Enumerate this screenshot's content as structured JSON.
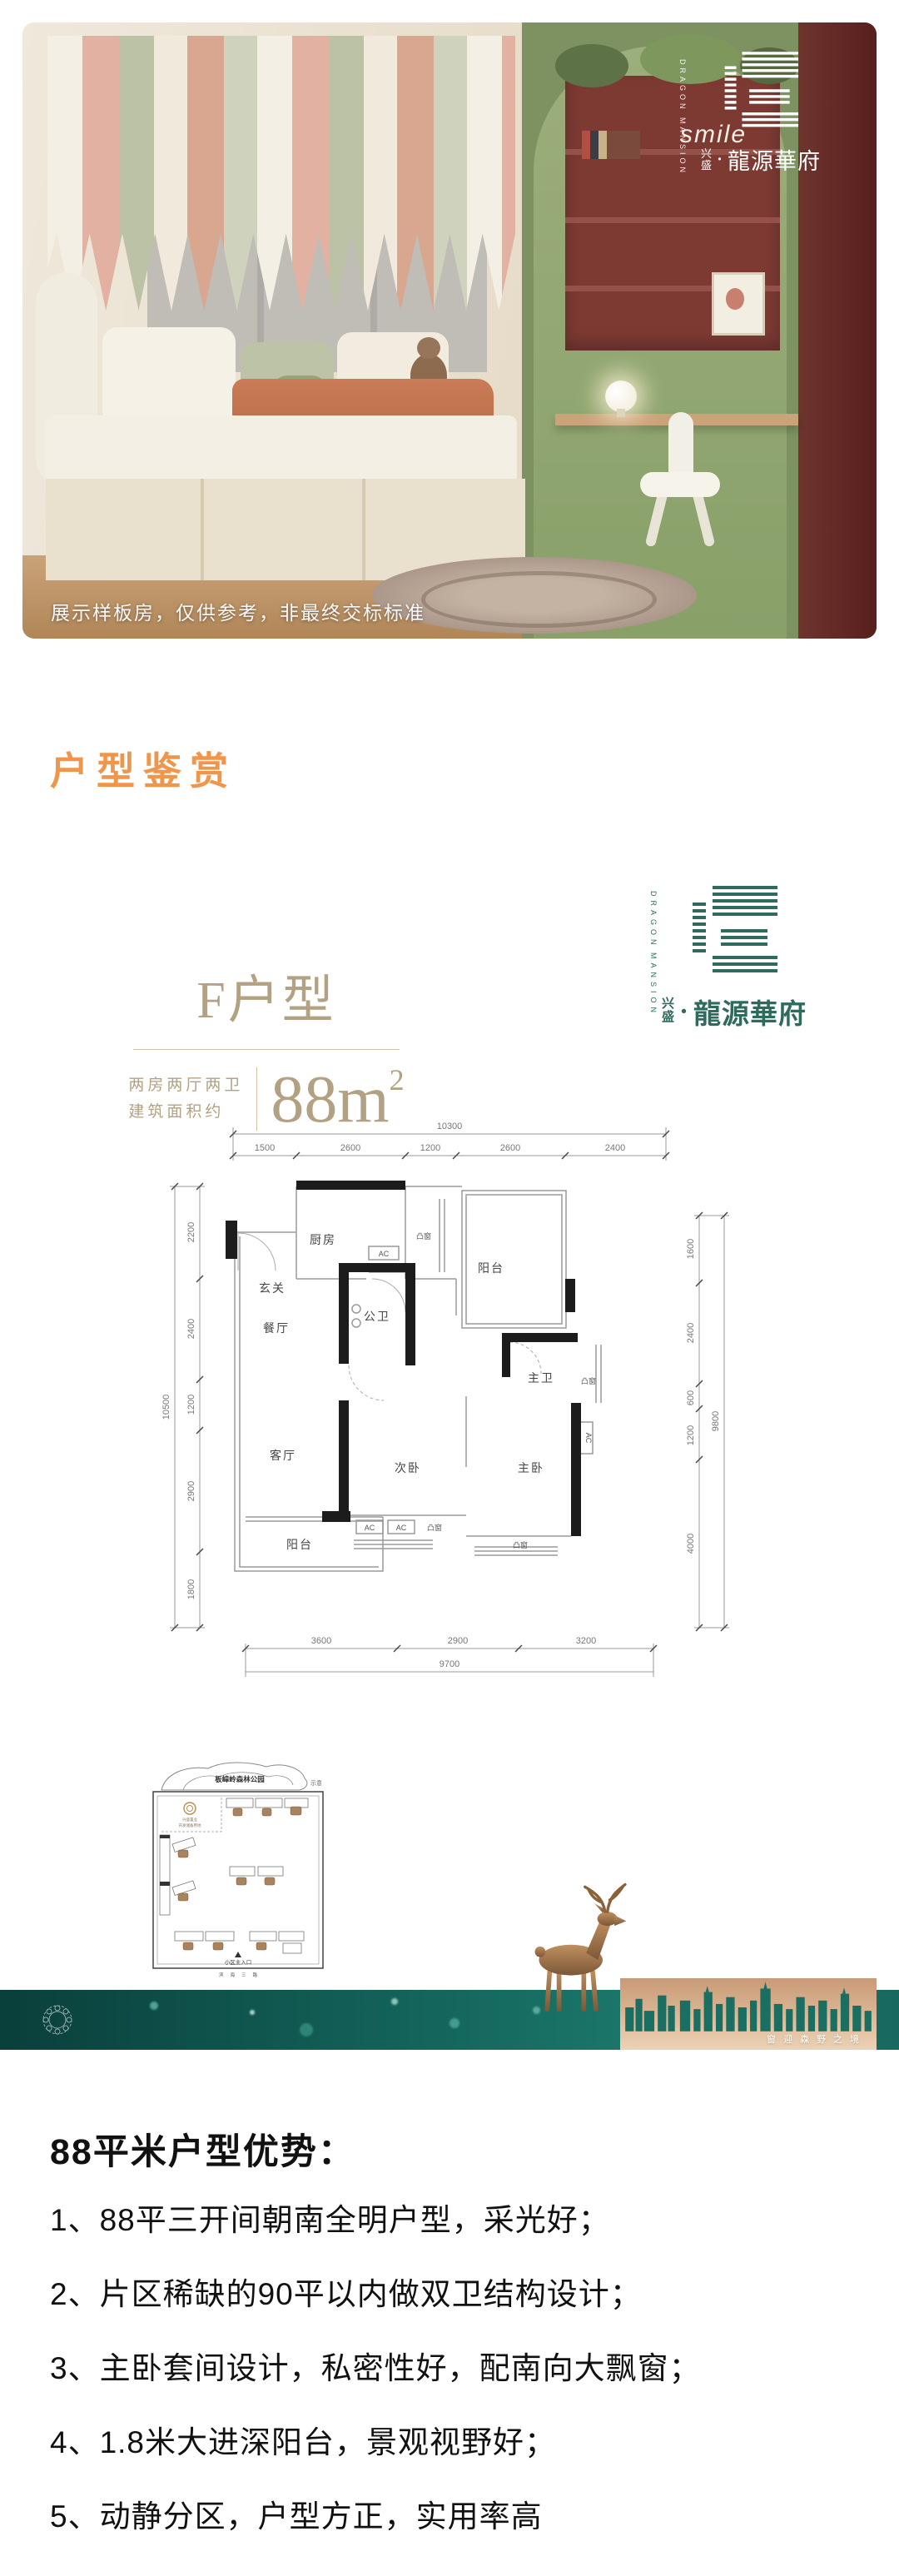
{
  "hero": {
    "watermark": "展示样板房，仅供参考，非最终交标标准",
    "decor_text": "smile"
  },
  "brand": {
    "en1": "DRAGON",
    "en2": "MANSION",
    "small_top": "兴",
    "small_bottom": "盛",
    "dot": "·",
    "name": "龍源華府",
    "green": "#2E6B5C"
  },
  "section": {
    "title": "户型鉴赏",
    "accent_color": "#F0964B"
  },
  "plan": {
    "type_name": "F户型",
    "spec_line1": "两房两厅两卫",
    "spec_line2": "建筑面积约",
    "area_base": "88m",
    "area_exp": "2",
    "rooms": {
      "entry": "玄关",
      "kitchen": "厨房",
      "dining": "餐厅",
      "living": "客厅",
      "balcony": "阳台",
      "bath_guest": "公卫",
      "bath_master": "主卫",
      "bed_second": "次卧",
      "bed_master": "主卧",
      "bay_window": "凸窗",
      "ac": "AC"
    },
    "dims": {
      "top_total": "10300",
      "top_segs": [
        "1500",
        "2600",
        "1200",
        "2600",
        "2400"
      ],
      "left_total": "10500",
      "left_segs": [
        "2200",
        "2400",
        "1200",
        "2900",
        "1800"
      ],
      "right_total": "9800",
      "right_segs": [
        "1600",
        "2400",
        "600",
        "1200",
        "4000"
      ],
      "bottom_total": "9700",
      "bottom_segs": [
        "3600",
        "2900",
        "3200"
      ]
    }
  },
  "siteplan": {
    "park": "板嶂岭森林公园",
    "note": "示意",
    "plot_line1": "兴盛置业",
    "plot_line2": "开发储备用地",
    "entrance": "小区主入口",
    "road": "滨海三路"
  },
  "banner": {
    "slogan": "窗迎森野之境",
    "teal": "#13635A",
    "card_tan": "#D9A77F"
  },
  "advantages": {
    "title": "88平米户型优势：",
    "items": [
      "1、88平三开间朝南全明户型，采光好；",
      "2、片区稀缺的90平以内做双卫结构设计；",
      "3、主卧套间设计，私密性好，配南向大飘窗；",
      "4、1.8米大进深阳台，景观视野好；",
      "5、动静分区，户型方正，实用率高"
    ]
  }
}
